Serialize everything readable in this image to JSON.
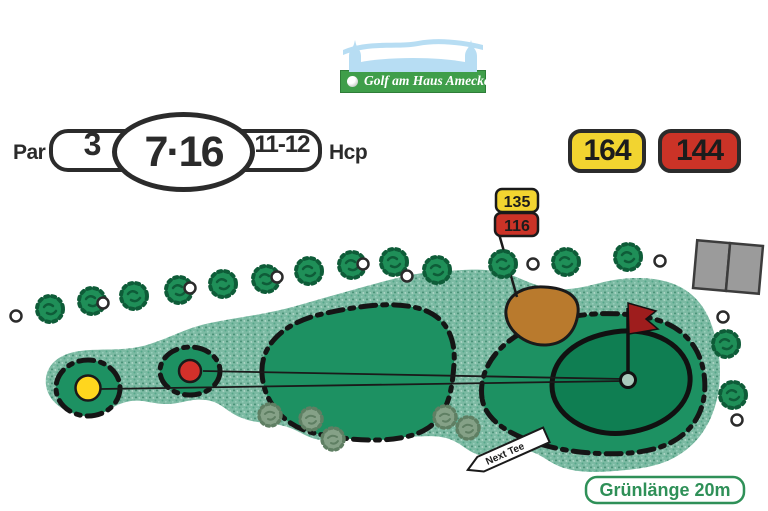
{
  "logo": {
    "title": "Golf am Haus Amecke"
  },
  "scorecard": {
    "par_label": "Par",
    "par_value": "3",
    "hole_numbers": "7·16",
    "hcp_range": "11-12",
    "hcp_label": "Hcp"
  },
  "distances": {
    "yellow_total": "164",
    "red_total": "144",
    "marker_yellow": "135",
    "marker_red": "116"
  },
  "map": {
    "next_tee_label": "Next Tee",
    "green_length_label": "Grünlänge 20m"
  },
  "colors": {
    "rough_green": "#7cbaa3",
    "fairway_green": "#1d9162",
    "putting_green": "#0f7e52",
    "bunker_brown": "#b97a2d",
    "tee_yellow": "#f2d430",
    "tee_red": "#cb3327",
    "flag_red": "#9e1d1d",
    "logo_banner_green": "#3f9e4a",
    "castle_blue": "#b7ddf3",
    "green_label_color": "#2f9058"
  }
}
